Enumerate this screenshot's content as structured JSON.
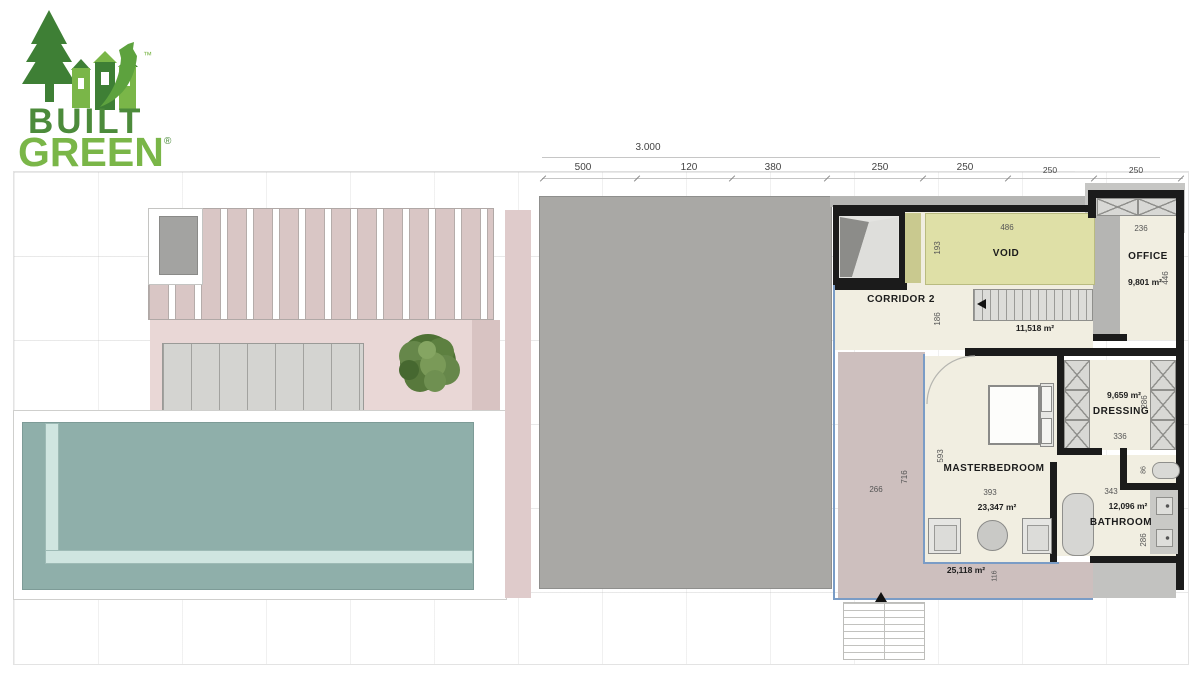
{
  "logo": {
    "line1": "BUILT",
    "line2": "GREEN",
    "registered": "®",
    "trademark": "™"
  },
  "dimensions": {
    "overall": "3.000",
    "top_ticks": [
      "500",
      "120",
      "380",
      "250",
      "250",
      "250",
      "250"
    ]
  },
  "rooms": {
    "void": {
      "label": "VOID",
      "width": "486",
      "height": "193"
    },
    "office": {
      "label": "OFFICE",
      "area": "9,801 m²",
      "width": "236",
      "height": "446"
    },
    "corridor2": {
      "label": "CORRIDOR 2",
      "area": "11,518 m²",
      "height": "186"
    },
    "masterbedroom": {
      "label": "MASTERBEDROOM",
      "area": "23,347 m²",
      "width": "393",
      "height": "593"
    },
    "dressing": {
      "label": "DRESSING",
      "area": "9,659 m²",
      "width": "336",
      "height": "286"
    },
    "wc": {
      "height": "86"
    },
    "bathroom": {
      "label": "BATHROOM",
      "area": "12,096 m²",
      "width": "343",
      "height": "286"
    },
    "terrace": {
      "area": "25,118 m²",
      "width": "266",
      "height": "716",
      "strip": "116"
    }
  },
  "colors": {
    "logo_dark": "#3e7f35",
    "logo_mid": "#5da23e",
    "logo_light": "#7ab648",
    "stripe_pink": "#d9c6c5",
    "terrace_pink": "#e9d7d6",
    "strip_pink": "#d8c3c2",
    "roof_gray": "#a9a8a5",
    "pool_teal": "#8fafaa",
    "pool_mint": "#cfe5e0",
    "floor_cream": "#f1eee1",
    "void_yellow": "#dfe0a7",
    "terrace_gray": "#cdbfbe",
    "wall_black": "#1b1b1b",
    "outline_blue": "#7a9cc6"
  }
}
